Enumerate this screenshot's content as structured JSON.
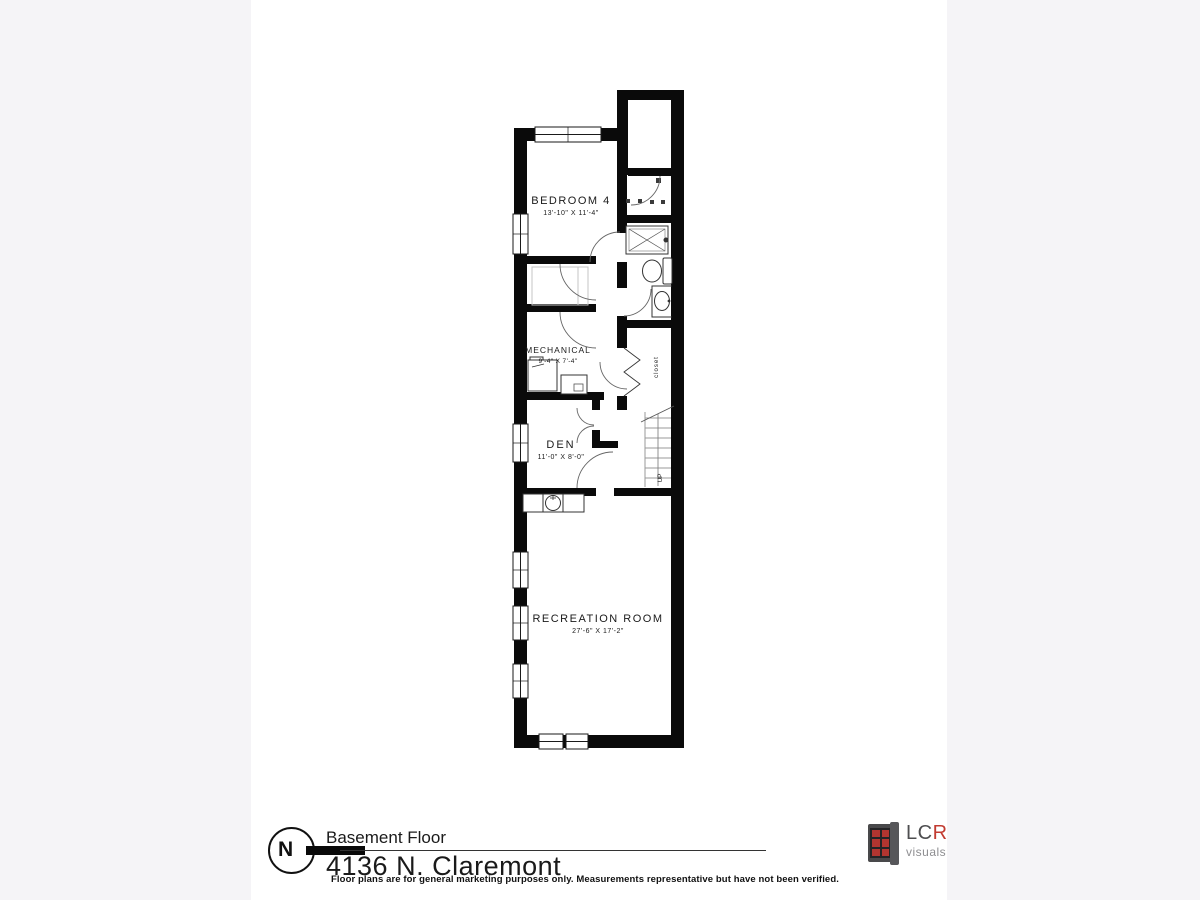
{
  "title_block": {
    "north_label": "N",
    "floor_name": "Basement Floor",
    "address": "4136 N. Claremont"
  },
  "floor_plan": {
    "rooms": [
      {
        "name": "BEDROOM 4",
        "dimensions": "13'-10\" X 11'-4\""
      },
      {
        "name": "MECHANICAL",
        "dimensions": "9'-4\" X 7'-4\""
      },
      {
        "name": "DEN",
        "dimensions": "11'-0\" X 8'-0\""
      },
      {
        "name": "RECREATION ROOM",
        "dimensions": "27'-6\" X 17'-2\""
      }
    ],
    "stair_label": "UP",
    "closet_label": "closet"
  },
  "logo": {
    "brand_prefix": "LC",
    "brand_suffix": "R",
    "tagline": "visuals"
  },
  "disclaimer": "Floor plans are for general marketing purposes only. Measurements representative but have not been verified.",
  "colors": {
    "wall": "#0a0a0a",
    "side_panel": "#f5f4f7",
    "logo_red": "#b23530",
    "logo_gray": "#4e4e50"
  }
}
